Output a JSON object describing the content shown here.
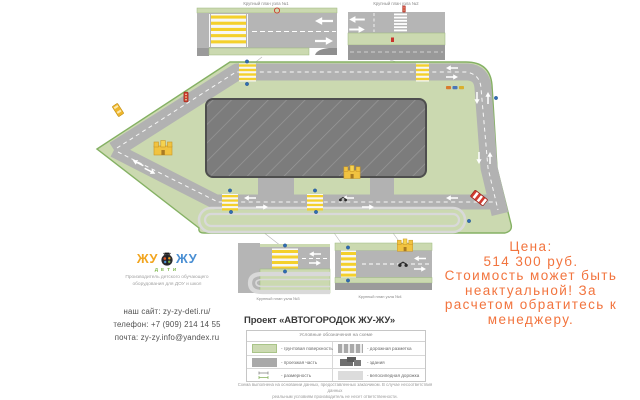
{
  "branding": {
    "logo_left": "ЖУ",
    "logo_right": "ЖУ",
    "logo_sub": "ДЕТИ",
    "tagline1": "Производитель детского обучающего",
    "tagline2": "оборудования для ДОУ и школ",
    "colors": {
      "orange": "#F2A51F",
      "blue": "#4A8FD3",
      "green": "#7AB648"
    }
  },
  "contacts": {
    "site": "наш сайт: zy-zy-deti.ru/",
    "phone": "телефон: +7 (909) 214 14 55",
    "email": "почта: zy-zy.info@yandex.ru"
  },
  "price": {
    "line1": "Цена:",
    "line2": "514 300 руб.",
    "line3": "Стоимость может быть",
    "line4": "неактуальной! За",
    "line5": "расчетом обратитесь к",
    "line6": "менеджеру.",
    "color": "#F2743E"
  },
  "plan": {
    "d1": "Крупный план узла №1",
    "d2": "Крупный план узла №2",
    "d3": "Крупный план узла №3",
    "d4": "Крупный план узла №4",
    "colors": {
      "ground": "#CBD9B0",
      "ground_border": "#85B164",
      "road": "#B2B2B2",
      "building": "#7C7C7C",
      "bike_path": "#D9D9D9",
      "zebra_yellow": "#F4D02C"
    }
  },
  "legend": {
    "title": "Проект «АВТОГОРОДОК ЖУ-ЖУ»",
    "header": "Условные обозначения на схеме",
    "items": [
      {
        "label": "- грунтовая поверхность",
        "swatch": "ground-surface"
      },
      {
        "label": "- проезжая часть",
        "swatch": "roadway"
      },
      {
        "label": "- размерность",
        "swatch": "dimension-marks"
      },
      {
        "label": "- дорожная разметка",
        "swatch": "road-marking"
      },
      {
        "label": "- здания",
        "swatch": "buildings"
      },
      {
        "label": "- велосипедная дорожка",
        "swatch": "bike-path"
      }
    ],
    "disc1": "Схема выполнена на основании данных, предоставленных заказчиком. В случае несоответствия данных",
    "disc2": "реальным условиям производитель не несет ответственности."
  }
}
